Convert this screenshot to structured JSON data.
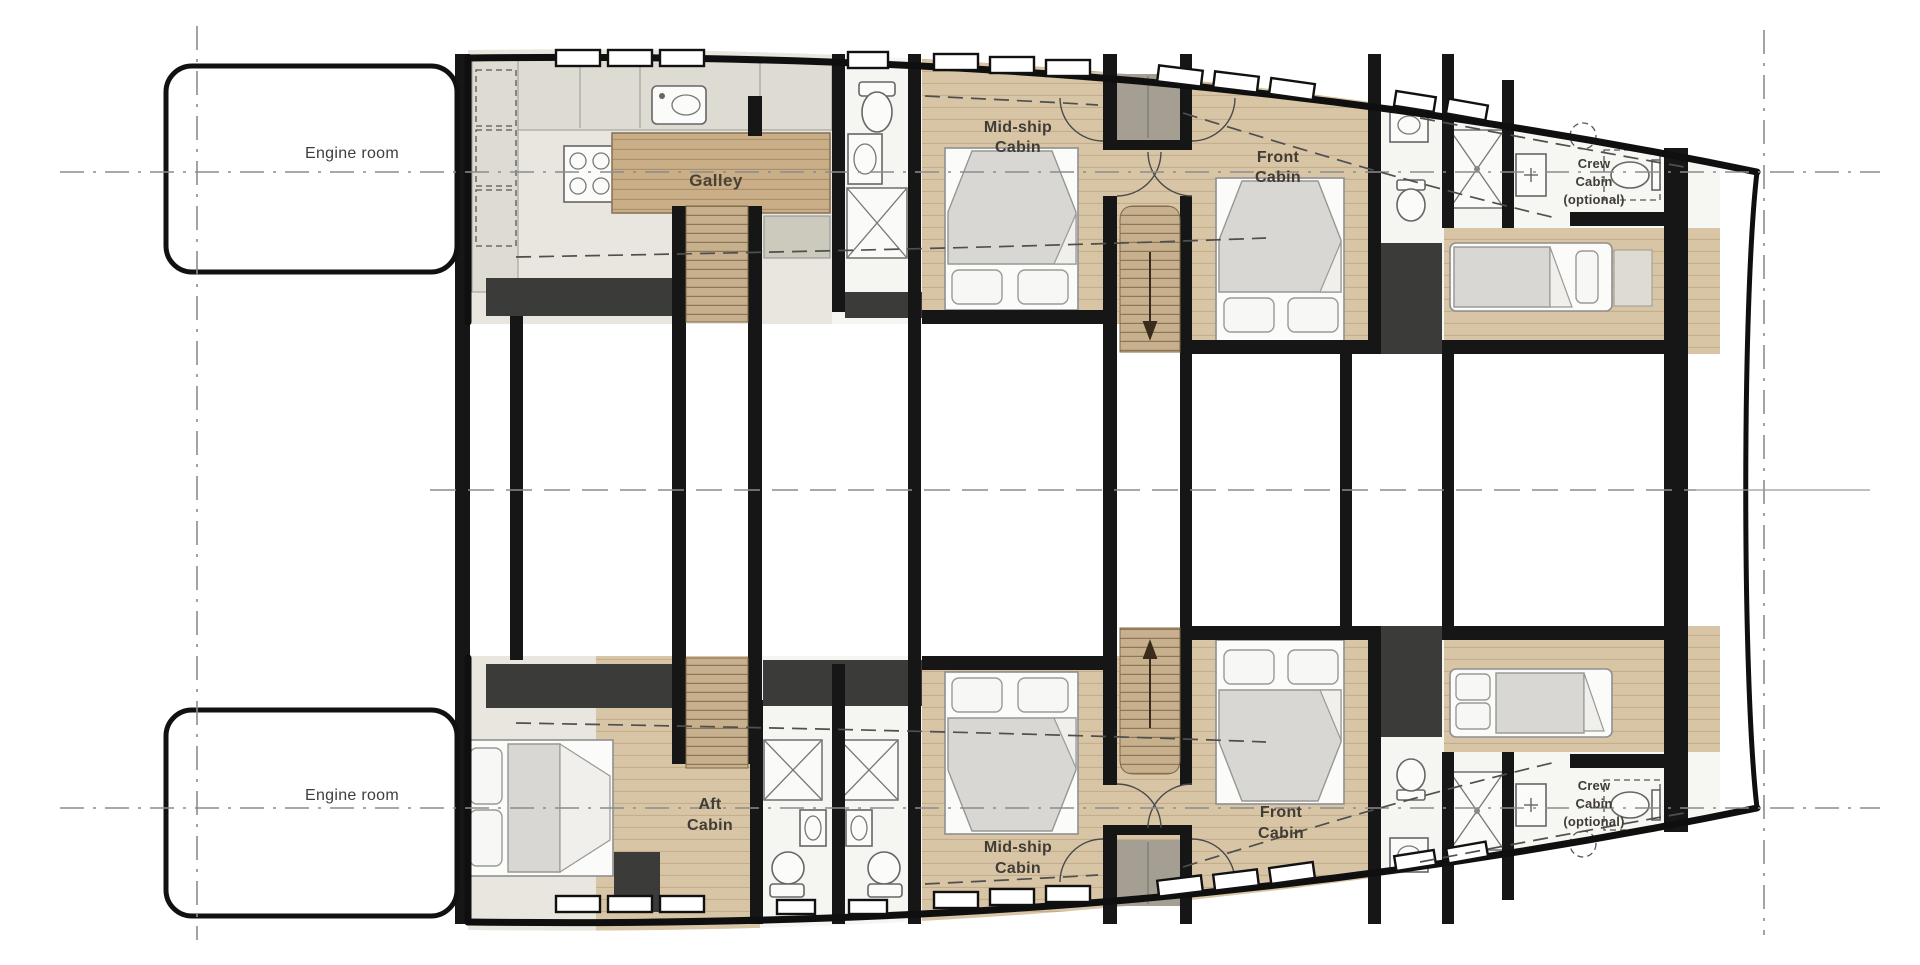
{
  "colors": {
    "wall": "#161616",
    "slab": "#3b3b39",
    "taupe": "#a59f93",
    "wood": "#d8c5a6",
    "woodDark": "#c7b08e",
    "floor": "#e8e6df",
    "bath": "#f5f5f2",
    "counter": "#dddbd2",
    "duvet": "#d9d7d3",
    "sheet": "#fbfbf9",
    "text": "#413c35"
  },
  "rooms": {
    "engine_room_port": {
      "label": "Engine room"
    },
    "engine_room_starboard": {
      "label": "Engine room"
    },
    "galley": {
      "label": "Galley"
    },
    "midship_cabin_port": {
      "l1": "Mid-ship",
      "l2": "Cabin"
    },
    "front_cabin_port": {
      "l1": "Front",
      "l2": "Cabin"
    },
    "crew_cabin_port": {
      "l1": "Crew",
      "l2": "Cabin",
      "l3": "(optional)"
    },
    "aft_cabin_starboard": {
      "l1": "Aft",
      "l2": "Cabin"
    },
    "midship_cabin_starboard": {
      "l1": "Mid-ship",
      "l2": "Cabin"
    },
    "front_cabin_starboard": {
      "l1": "Front",
      "l2": "Cabin"
    },
    "crew_cabin_starboard": {
      "l1": "Crew",
      "l2": "Cabin",
      "l3": "(optional)"
    }
  }
}
